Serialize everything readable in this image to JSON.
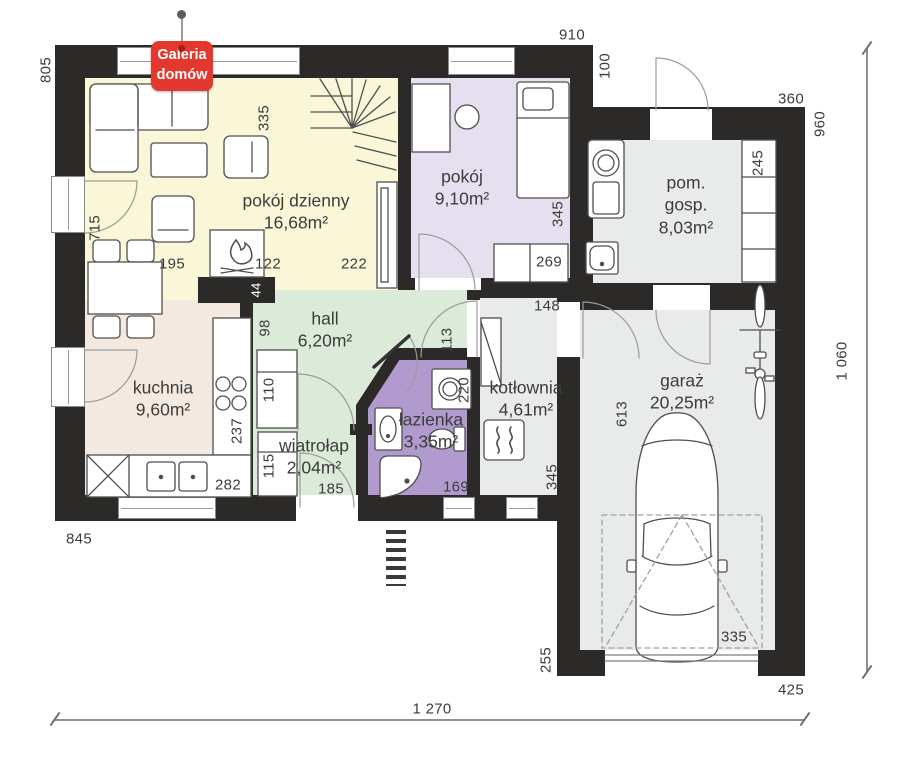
{
  "logo": {
    "line1": "Galeria",
    "line2": "domów"
  },
  "rooms": {
    "living": {
      "name": "pokój dzienny",
      "area": "16,68m²"
    },
    "bedroom": {
      "name": "pokój",
      "area": "9,10m²"
    },
    "utility": {
      "name": "pom. gosp.",
      "area": "8,03m²"
    },
    "hall": {
      "name": "hall",
      "area": "6,20m²"
    },
    "kitchen": {
      "name": "kuchnia",
      "area": "9,60m²"
    },
    "vestibule": {
      "name": "wiatrołap",
      "area": "2,04m²"
    },
    "bathroom": {
      "name": "łazienka",
      "area": "3,35m²"
    },
    "boiler": {
      "name": "kotłownia",
      "area": "4,61m²"
    },
    "garage": {
      "name": "garaż",
      "area": "20,25m²"
    }
  },
  "dimensions": {
    "left_height": "805",
    "living_left": "715",
    "living_top": "335",
    "dining": "195",
    "fireplace": "122",
    "living_right": "222",
    "chimney": "44",
    "top_width": "910",
    "top_offset": "100",
    "utility_top": "360",
    "right_upper": "960",
    "right_total": "1 060",
    "bedroom_right": "345",
    "bedroom_dresser": "269",
    "utility_shelf": "245",
    "hall_left": "98",
    "hall_cabinet": "110",
    "vestibule_cabinet": "115",
    "entry_door": "185",
    "kitchen_counter": "237",
    "kitchen_bottom": "282",
    "bottom_left": "845",
    "hall_right": "113",
    "bath_washer": "220",
    "bath_bottom": "169",
    "boiler_top": "148",
    "boiler_height": "345",
    "garage_depth": "613",
    "garage_door": "335",
    "garage_left": "255",
    "bottom_right": "425",
    "bottom_total": "1 270"
  },
  "colors": {
    "wall": "#2b2a28",
    "living": "#faf6d8",
    "bedroom": "#e6dff0",
    "bathroom": "#b19bce",
    "green": "#dcead9",
    "kitchen": "#f4e9e0",
    "gray": "#e9ebea",
    "logo_red": "#e2382e"
  }
}
